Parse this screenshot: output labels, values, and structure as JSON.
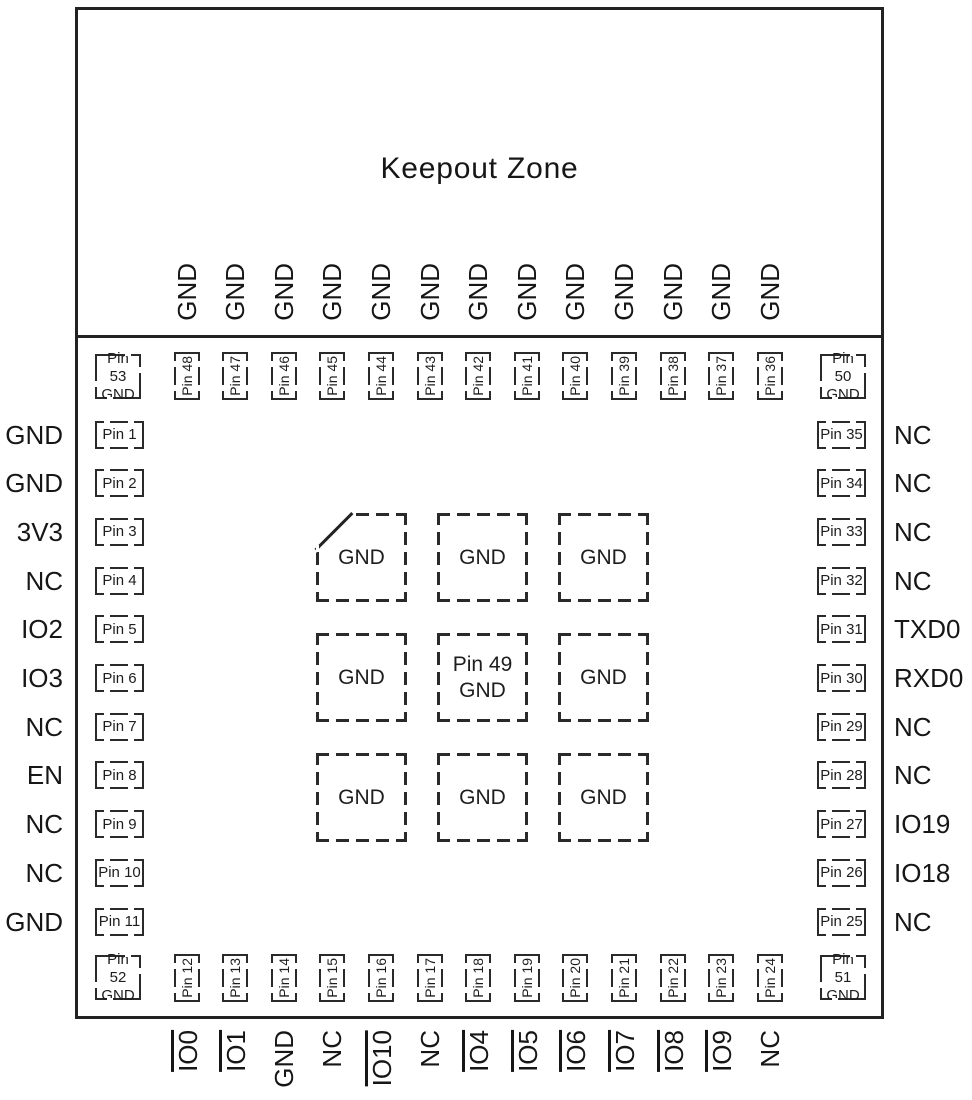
{
  "title": "Keepout Zone",
  "colors": {
    "ink": "#1d1d1d",
    "outline": "#222222",
    "background": "#ffffff"
  },
  "module": {
    "corner_pads": [
      {
        "pin": "Pin 53",
        "signal": "GND",
        "position": "top-left"
      },
      {
        "pin": "Pin 50",
        "signal": "GND",
        "position": "top-right"
      },
      {
        "pin": "Pin 52",
        "signal": "GND",
        "position": "bottom-left"
      },
      {
        "pin": "Pin 51",
        "signal": "GND",
        "position": "bottom-right"
      }
    ],
    "top_row": [
      {
        "pin": "Pin 48",
        "signal": "GND"
      },
      {
        "pin": "Pin 47",
        "signal": "GND"
      },
      {
        "pin": "Pin 46",
        "signal": "GND"
      },
      {
        "pin": "Pin 45",
        "signal": "GND"
      },
      {
        "pin": "Pin 44",
        "signal": "GND"
      },
      {
        "pin": "Pin 43",
        "signal": "GND"
      },
      {
        "pin": "Pin 42",
        "signal": "GND"
      },
      {
        "pin": "Pin 41",
        "signal": "GND"
      },
      {
        "pin": "Pin 40",
        "signal": "GND"
      },
      {
        "pin": "Pin 39",
        "signal": "GND"
      },
      {
        "pin": "Pin 38",
        "signal": "GND"
      },
      {
        "pin": "Pin 37",
        "signal": "GND"
      },
      {
        "pin": "Pin 36",
        "signal": "GND"
      }
    ],
    "left_col": [
      {
        "pin": "Pin 1",
        "signal": "GND"
      },
      {
        "pin": "Pin 2",
        "signal": "GND"
      },
      {
        "pin": "Pin 3",
        "signal": "3V3"
      },
      {
        "pin": "Pin 4",
        "signal": "NC"
      },
      {
        "pin": "Pin 5",
        "signal": "IO2"
      },
      {
        "pin": "Pin 6",
        "signal": "IO3"
      },
      {
        "pin": "Pin 7",
        "signal": "NC"
      },
      {
        "pin": "Pin 8",
        "signal": "EN"
      },
      {
        "pin": "Pin 9",
        "signal": "NC"
      },
      {
        "pin": "Pin 10",
        "signal": "NC"
      },
      {
        "pin": "Pin 11",
        "signal": "GND"
      }
    ],
    "right_col": [
      {
        "pin": "Pin 35",
        "signal": "NC"
      },
      {
        "pin": "Pin 34",
        "signal": "NC"
      },
      {
        "pin": "Pin 33",
        "signal": "NC"
      },
      {
        "pin": "Pin 32",
        "signal": "NC"
      },
      {
        "pin": "Pin 31",
        "signal": "TXD0"
      },
      {
        "pin": "Pin 30",
        "signal": "RXD0"
      },
      {
        "pin": "Pin 29",
        "signal": "NC"
      },
      {
        "pin": "Pin 28",
        "signal": "NC"
      },
      {
        "pin": "Pin 27",
        "signal": "IO19"
      },
      {
        "pin": "Pin 26",
        "signal": "IO18"
      },
      {
        "pin": "Pin 25",
        "signal": "NC"
      }
    ],
    "bottom_row": [
      {
        "pin": "Pin 12",
        "signal": "IO0",
        "orientation_line": true
      },
      {
        "pin": "Pin 13",
        "signal": "IO1",
        "orientation_line": true
      },
      {
        "pin": "Pin 14",
        "signal": "GND",
        "orientation_line": false
      },
      {
        "pin": "Pin 15",
        "signal": "NC",
        "orientation_line": false
      },
      {
        "pin": "Pin 16",
        "signal": "IO10",
        "orientation_line": true
      },
      {
        "pin": "Pin 17",
        "signal": "NC",
        "orientation_line": false
      },
      {
        "pin": "Pin 18",
        "signal": "IO4",
        "orientation_line": true
      },
      {
        "pin": "Pin 19",
        "signal": "IO5",
        "orientation_line": true
      },
      {
        "pin": "Pin 20",
        "signal": "IO6",
        "orientation_line": true
      },
      {
        "pin": "Pin 21",
        "signal": "IO7",
        "orientation_line": true
      },
      {
        "pin": "Pin 22",
        "signal": "IO8",
        "orientation_line": true
      },
      {
        "pin": "Pin 23",
        "signal": "IO9",
        "orientation_line": true
      },
      {
        "pin": "Pin 24",
        "signal": "NC",
        "orientation_line": false
      }
    ],
    "center_pads": [
      {
        "label": "GND",
        "chamfer": true
      },
      {
        "label": "GND"
      },
      {
        "label": "GND"
      },
      {
        "label": "GND"
      },
      {
        "pin": "Pin 49",
        "label": "GND"
      },
      {
        "label": "GND"
      },
      {
        "label": "GND"
      },
      {
        "label": "GND"
      },
      {
        "label": "GND"
      }
    ]
  }
}
